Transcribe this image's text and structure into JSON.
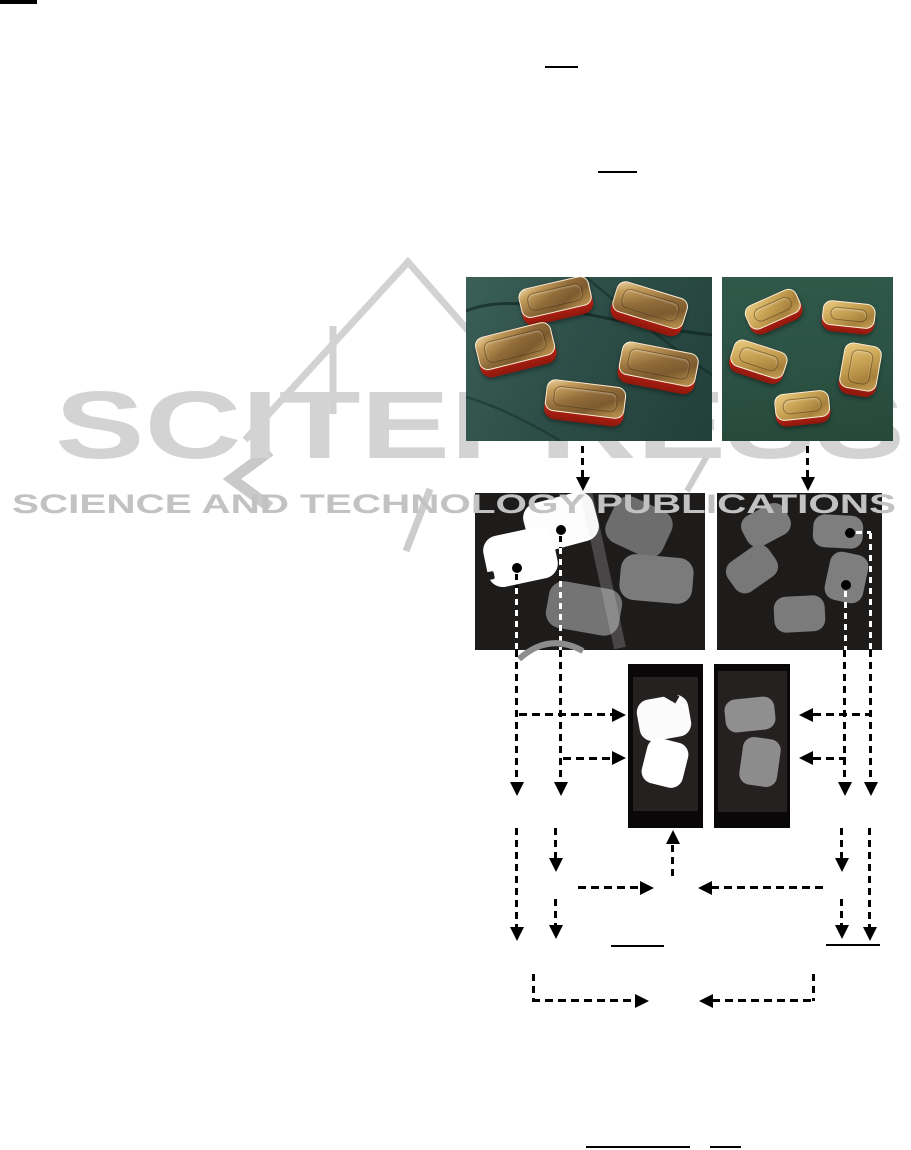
{
  "watermark": {
    "title": "SCITEPRESS",
    "subtitle": "SCIENCE AND TECHNOLOGY PUBLICATIONS",
    "title_color": "#d3d3d3",
    "subtitle_color": "#c2c2c2"
  },
  "figure": {
    "colors": {
      "tin_red": "#c62819",
      "lid_gold": "#b98c4a",
      "photo_bg_left": "#2e5049",
      "photo_bg_right": "#2b5245",
      "mask_bg": "#1e1b1b",
      "blob_white": "#ffffff",
      "blob_gray_dark": "#6d6d6d",
      "blob_gray": "#7b7b7b",
      "crop_blob_gray": "#909090",
      "arrow_color": "#000000"
    },
    "panels": {
      "photo_left_tins": 5,
      "photo_right_tins": 5,
      "mask_left_blobs": 5,
      "mask_right_blobs": 5,
      "crop_left_blobs": 2,
      "crop_right_blobs": 2
    }
  }
}
